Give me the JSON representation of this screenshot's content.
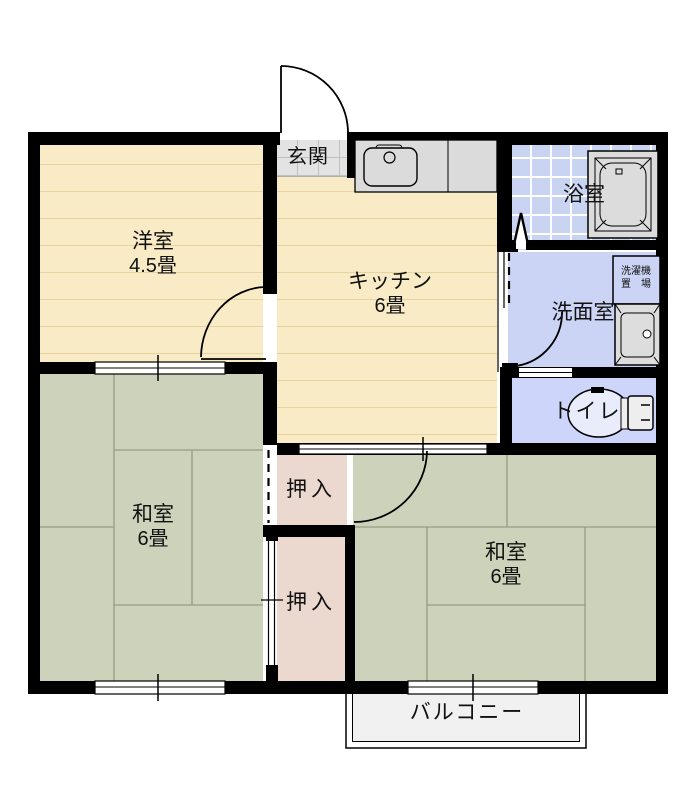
{
  "title": "2DK apartment floor plan",
  "rooms": {
    "genkan": {
      "label": "玄関"
    },
    "western_room": {
      "label": "洋室",
      "size": "4.5畳"
    },
    "kitchen": {
      "label": "キッチン",
      "size": "6畳"
    },
    "bathroom": {
      "label": "浴室"
    },
    "laundry_space": {
      "line1": "洗濯機",
      "line2": "置　場"
    },
    "washroom": {
      "label": "洗面室"
    },
    "toilet": {
      "label": "トイレ"
    },
    "japanese_room_left": {
      "label": "和室",
      "size": "6畳"
    },
    "japanese_room_right": {
      "label": "和室",
      "size": "6畳"
    },
    "closet_upper": {
      "label": "押入"
    },
    "closet_lower": {
      "label": "押入"
    },
    "balcony": {
      "label": "バルコニー"
    }
  },
  "colors": {
    "wall": "#000000",
    "wood_floor": "#F8EBC6",
    "wood_floor_stripe": "#E6D3A0",
    "tatami": "#CDD3BA",
    "tatami_line": "#949D80",
    "closet": "#EBD8CE",
    "bath_tile": "#C9D4F2",
    "washroom": "#CBD4F4",
    "toilet_room": "#CDD6FA",
    "genkan_tile": "#E3E3E3",
    "fixture_gray": "#DBDBDB",
    "balcony": "#F1F1F1"
  }
}
